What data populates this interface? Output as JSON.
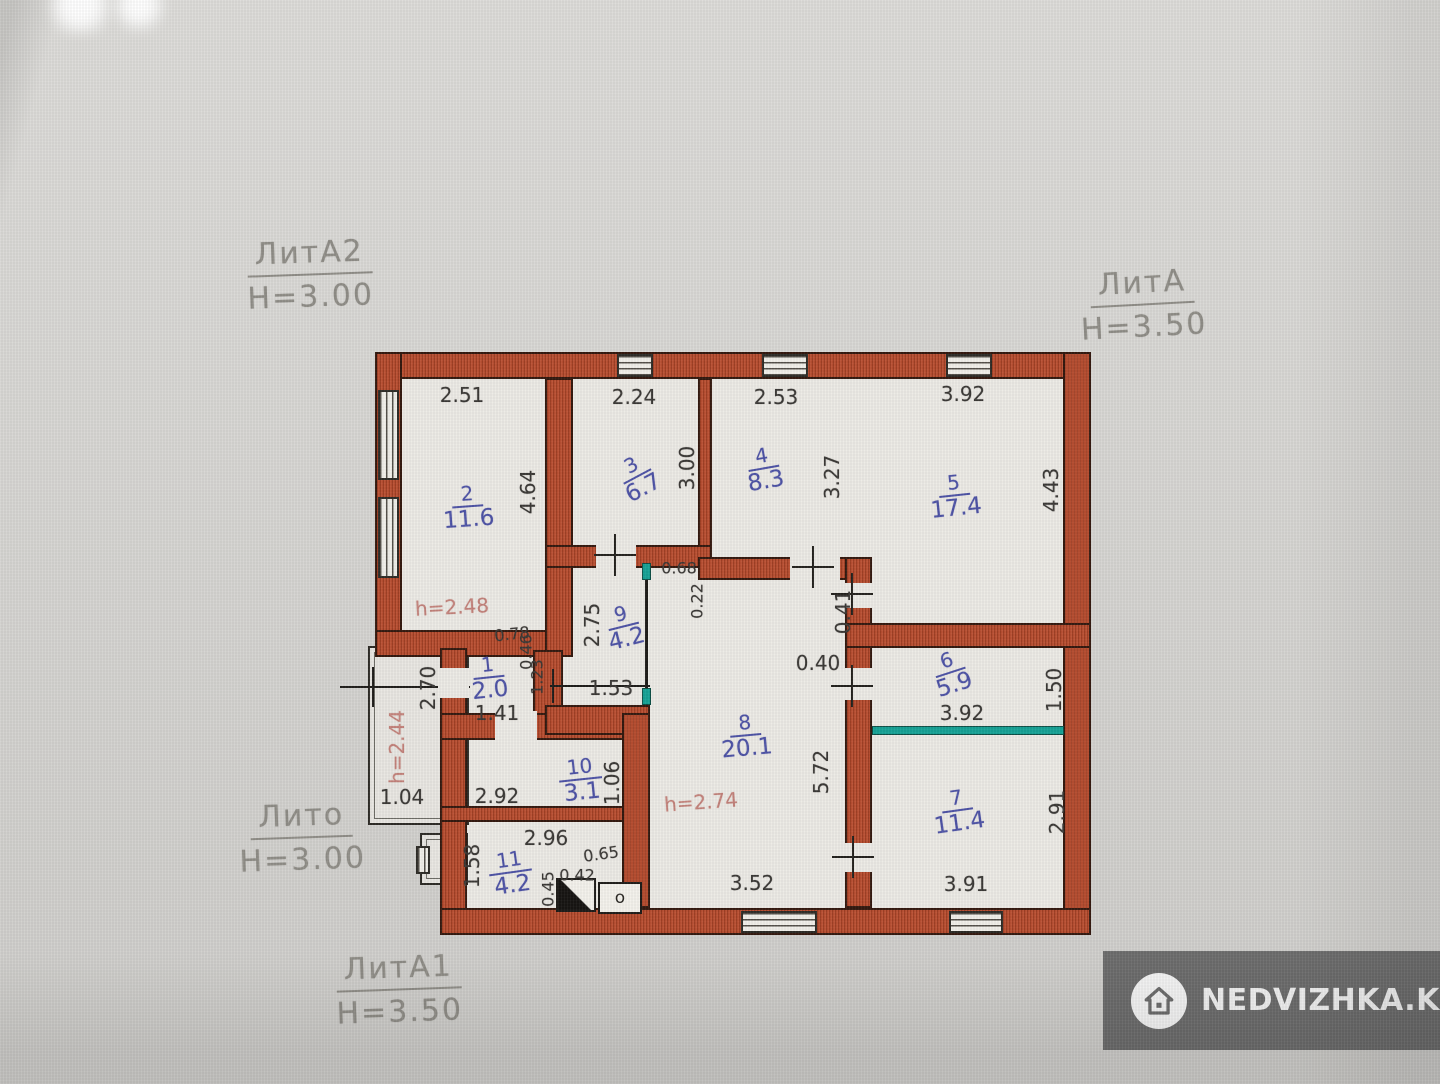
{
  "annotations": {
    "lit_a2": {
      "name": "ЛитА2",
      "height": "H=3.00"
    },
    "lit_a": {
      "name": "ЛитА",
      "height": "H=3.50"
    },
    "lit_o": {
      "name": "Лито",
      "height": "H=3.00"
    },
    "lit_a1": {
      "name": "ЛитА1",
      "height": "H=3.50"
    }
  },
  "plan": {
    "rooms": [
      {
        "num": "1",
        "area": "2.0"
      },
      {
        "num": "2",
        "area": "11.6",
        "h_note": "h=2.48"
      },
      {
        "num": "3",
        "area": "6.7"
      },
      {
        "num": "4",
        "area": "8.3"
      },
      {
        "num": "5",
        "area": "17.4"
      },
      {
        "num": "6",
        "area": "5.9"
      },
      {
        "num": "7",
        "area": "11.4"
      },
      {
        "num": "8",
        "area": "20.1",
        "h_note": "h=2.74"
      },
      {
        "num": "9",
        "area": "4.2"
      },
      {
        "num": "10",
        "area": "3.1"
      },
      {
        "num": "11",
        "area": "4.2"
      }
    ],
    "porch": {
      "depth": "2.70",
      "h_note": "h=2.44",
      "width": "1.04"
    },
    "dims": {
      "r2_w": "2.51",
      "r2_d": "4.64",
      "r3_w": "2.24",
      "r3_d": "3.00",
      "r4_w": "2.53",
      "r4_d": "3.27",
      "r5_w": "3.92",
      "r5_d": "4.43",
      "r9_d": "2.75",
      "r9_w": "1.53",
      "d_068": "0.68",
      "d_022": "0.22",
      "d_041": "0.41",
      "d_040": "0.40",
      "r8_d": "5.72",
      "r8_w": "3.52",
      "r1_w": "1.41",
      "d_078": "0.78",
      "d_046": "0.46",
      "d_123": "1.23",
      "r6_w": "3.92",
      "r6_d": "1.50",
      "r7_w": "3.91",
      "r7_d": "2.91",
      "r10_w": "2.92",
      "r10_d": "1.06",
      "r11_w": "2.96",
      "r11_d": "1.58",
      "d_065": "0.65",
      "d_042": "0.42",
      "d_045": "0.45",
      "o_mark": "о"
    }
  },
  "watermark": {
    "text": "NEDVIZHKA.KZ",
    "icon": "house-icon"
  },
  "colors": {
    "wall": "#b24a2d",
    "teal_partition": "#16a296",
    "room_label_blue": "#4e53a6",
    "height_note_pink": "#c4837b",
    "dim_text": "#3b3936",
    "lit_label_gray": "#908e88",
    "watermark_bg": "#6d6d6d"
  }
}
